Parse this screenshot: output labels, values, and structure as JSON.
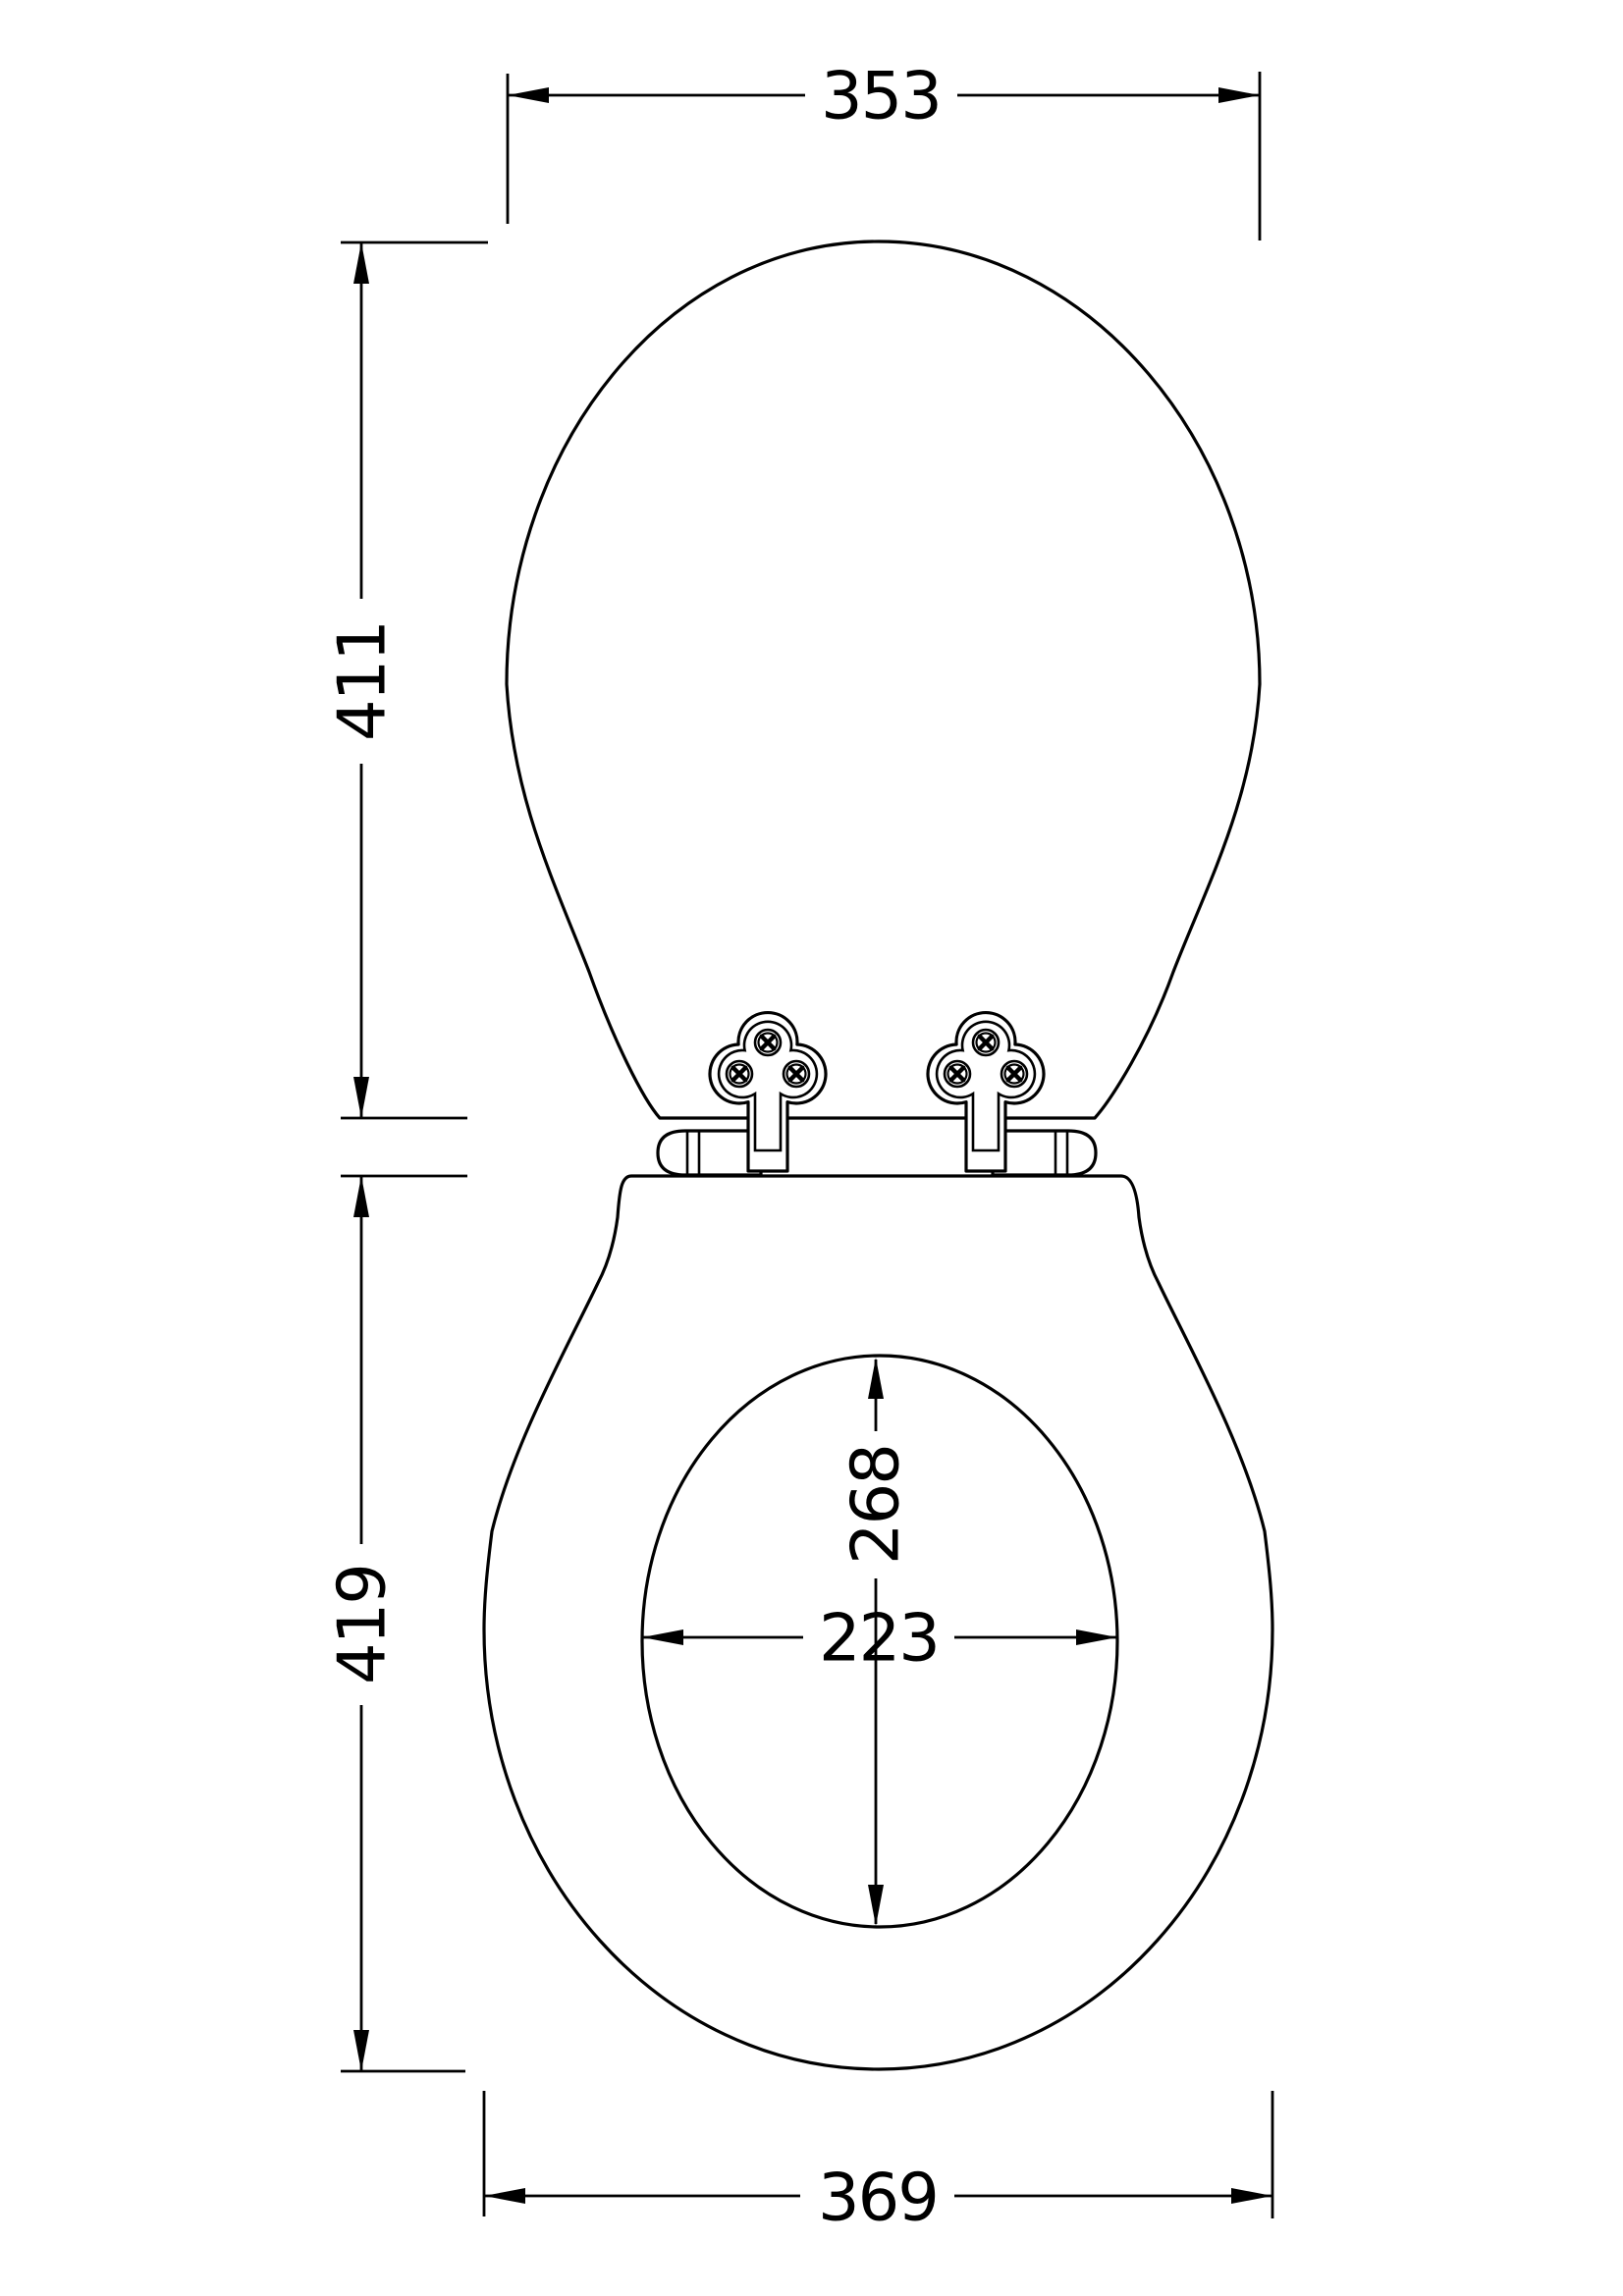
{
  "drawing": {
    "type": "technical-dimension-drawing",
    "subject": "toilet seat and lid, plan view with hinges",
    "background_color": "#ffffff",
    "line_color": "#000000",
    "dimensions": {
      "lid_width": "353",
      "lid_length": "411",
      "seat_length": "419",
      "aperture_length": "268",
      "aperture_width": "223",
      "seat_width": "369"
    }
  }
}
